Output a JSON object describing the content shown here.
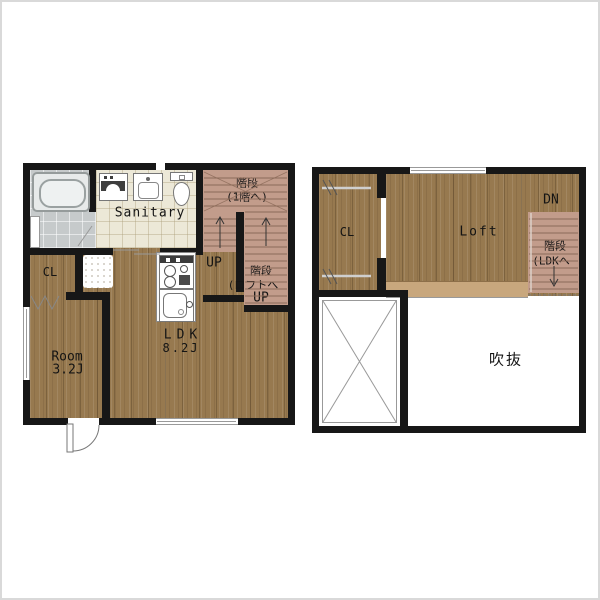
{
  "colors": {
    "wall": "#171717",
    "wood": "#97794f",
    "wood_band": "#c8a77d",
    "stairs": "#c29c8b",
    "stair_line": "#8b6a58",
    "tile_bath": "#c6cacb",
    "tile_sanitary": "#ece8d7",
    "fixture_line": "#777777",
    "text": "#141414",
    "detail_line": "#999999"
  },
  "left_plan": {
    "labels": {
      "sanitary": "Sanitary",
      "stairs_upper_line1": "階段",
      "stairs_upper_line2": "(1階へ)",
      "up_hall": "UP",
      "stairs_loft_line1": "階段",
      "stairs_loft_line2": "(ロフトへ",
      "up_loft": "UP",
      "closet": "CL",
      "ldk_name": "LDK",
      "ldk_size": "8.2J",
      "room_name": "Room",
      "room_size": "3.2J"
    }
  },
  "right_plan": {
    "labels": {
      "closet": "CL",
      "loft": "Loft",
      "down": "DN",
      "stairs_line1": "階段",
      "stairs_line2": "(LDKへ",
      "void": "吹抜"
    }
  }
}
